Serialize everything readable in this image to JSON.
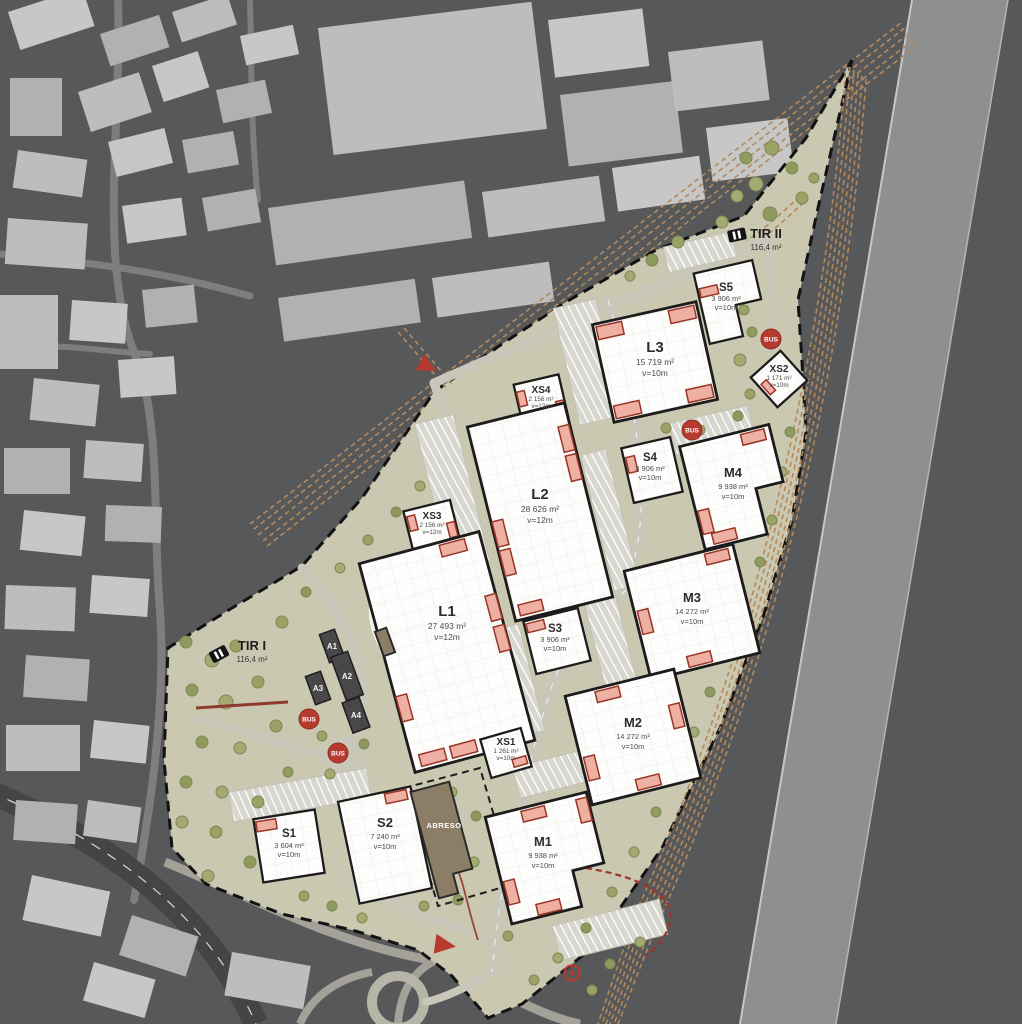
{
  "plan": {
    "bus_label": "BUS",
    "buildings": {
      "L1": {
        "label": "L1",
        "area": "27 493 m²",
        "height": "v=12m"
      },
      "L2": {
        "label": "L2",
        "area": "28 626 m²",
        "height": "v=12m"
      },
      "L3": {
        "label": "L3",
        "area": "15 719 m²",
        "height": "v=10m"
      },
      "M1": {
        "label": "M1",
        "area": "9 938 m²",
        "height": "v=10m"
      },
      "M2": {
        "label": "M2",
        "area": "14 272 m²",
        "height": "v=10m"
      },
      "M3": {
        "label": "M3",
        "area": "14 272 m²",
        "height": "v=10m"
      },
      "M4": {
        "label": "M4",
        "area": "9 938 m²",
        "height": "v=10m"
      },
      "S1": {
        "label": "S1",
        "area": "3 604 m²",
        "height": "v=10m"
      },
      "S2": {
        "label": "S2",
        "area": "7 240 m²",
        "height": "v=10m"
      },
      "S3": {
        "label": "S3",
        "area": "3 906 m²",
        "height": "v=10m"
      },
      "S4": {
        "label": "S4",
        "area": "3 906 m²",
        "height": "v=10m"
      },
      "S5": {
        "label": "S5",
        "area": "3 906 m²",
        "height": "v=10m"
      },
      "XS1": {
        "label": "XS1",
        "area": "1 261 m²",
        "height": "v=10m"
      },
      "XS2": {
        "label": "XS2",
        "area": "1 171 m²",
        "height": "v=10m"
      },
      "XS3": {
        "label": "XS3",
        "area": "2 156 m²",
        "height": "v=12m"
      },
      "XS4": {
        "label": "XS4",
        "area": "2 156 m²",
        "height": "v=12m"
      }
    },
    "tir": {
      "tir1": {
        "label": "TIR I",
        "area": "116,4 m²"
      },
      "tir2": {
        "label": "TIR II",
        "area": "116,4 m²"
      }
    },
    "annex": {
      "a1": "A1",
      "a2": "A2",
      "a3": "A3",
      "a4": "A4"
    },
    "abreso": {
      "label": "ABRESO"
    },
    "colors": {
      "accent_red": "#b63a2e",
      "site_green": "#cac8b0",
      "rail_tan": "#b4895c",
      "river_gray": "#8e8f91"
    }
  }
}
